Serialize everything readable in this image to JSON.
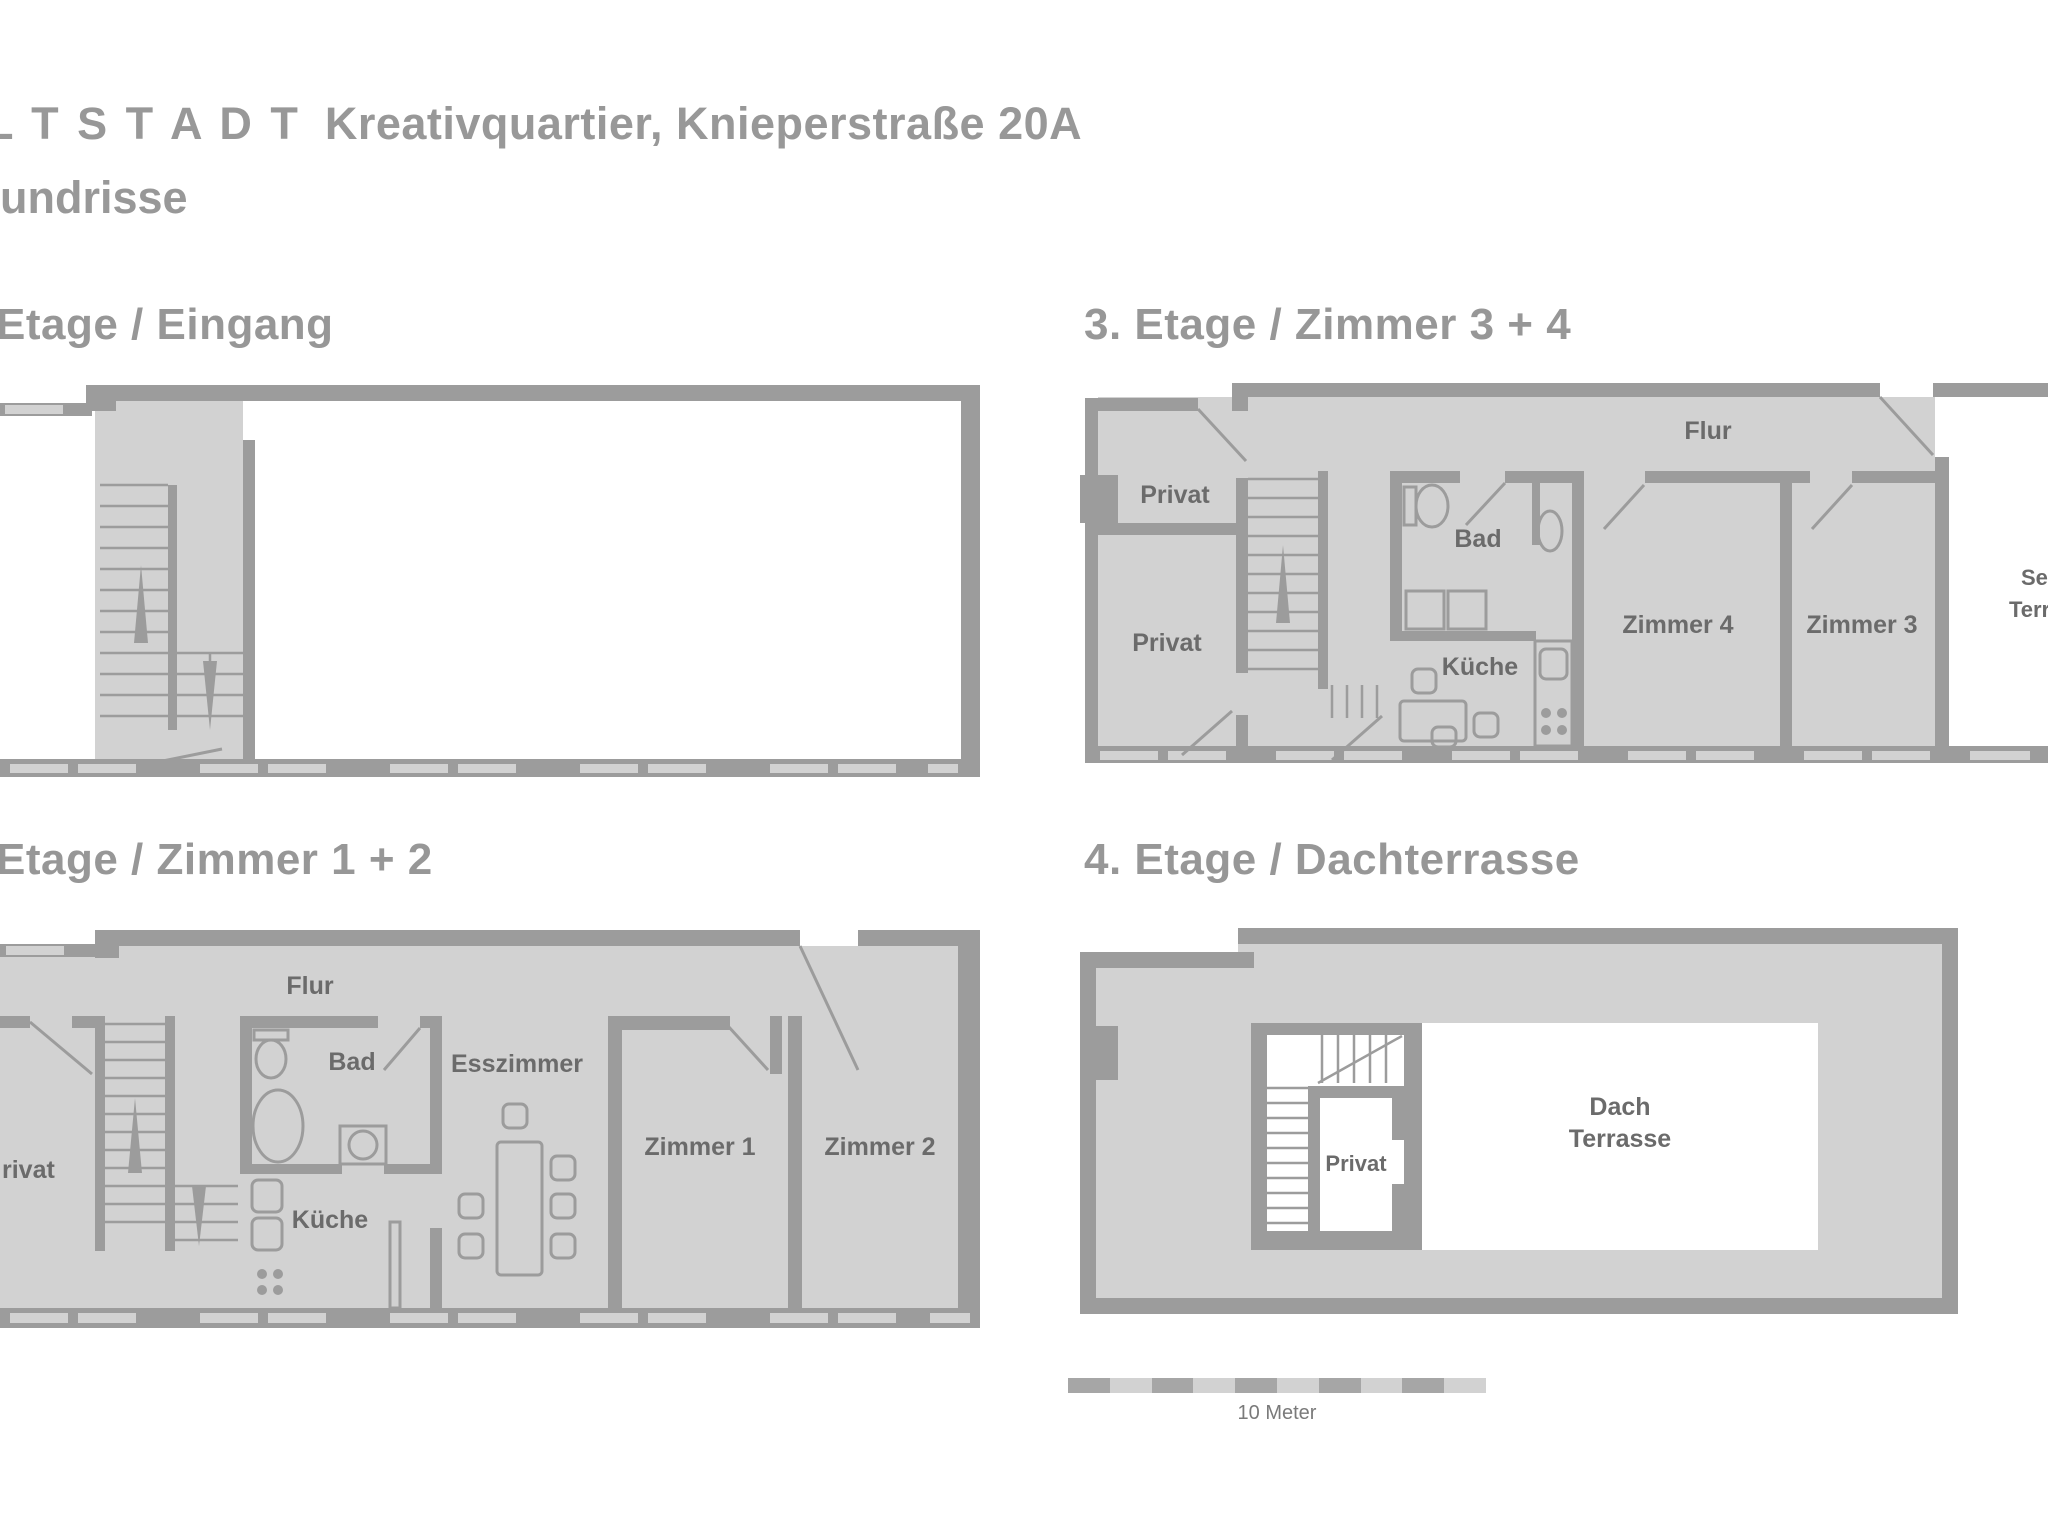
{
  "header": {
    "brand": "L T S T A D T",
    "title_rest": "Kreativquartier, Knieperstraße 20A",
    "subtitle": "undrisse"
  },
  "floors": {
    "floor1": {
      "heading": "Etage / Eingang",
      "labels": {}
    },
    "floor3": {
      "heading": "3. Etage / Zimmer 3 + 4",
      "labels": {
        "flur": "Flur",
        "privat_top": "Privat",
        "privat": "Privat",
        "bad": "Bad",
        "kueche": "Küche",
        "zimmer4": "Zimmer 4",
        "zimmer3": "Zimmer 3",
        "terrasse_line1": "Seiten",
        "terrasse_line2": "Terrasse"
      }
    },
    "floor2": {
      "heading": "Etage / Zimmer 1 + 2",
      "labels": {
        "flur": "Flur",
        "privat": "rivat",
        "bad": "Bad",
        "kueche": "Küche",
        "esszimmer": "Esszimmer",
        "zimmer1": "Zimmer 1",
        "zimmer2": "Zimmer 2"
      }
    },
    "floor4": {
      "heading": "4. Etage / Dachterrasse",
      "labels": {
        "privat": "Privat",
        "dach_line1": "Dach",
        "dach_line2": "Terrasse"
      }
    }
  },
  "scale_bar": {
    "label": "10 Meter"
  },
  "colors": {
    "background": "#ffffff",
    "floor_fill": "#d2d2d2",
    "wall": "#9c9c9c",
    "heading_text": "#979797",
    "room_label_text": "#6b6b6b",
    "scale_dark": "#a6a6a6",
    "scale_light": "#d2d2d2"
  }
}
